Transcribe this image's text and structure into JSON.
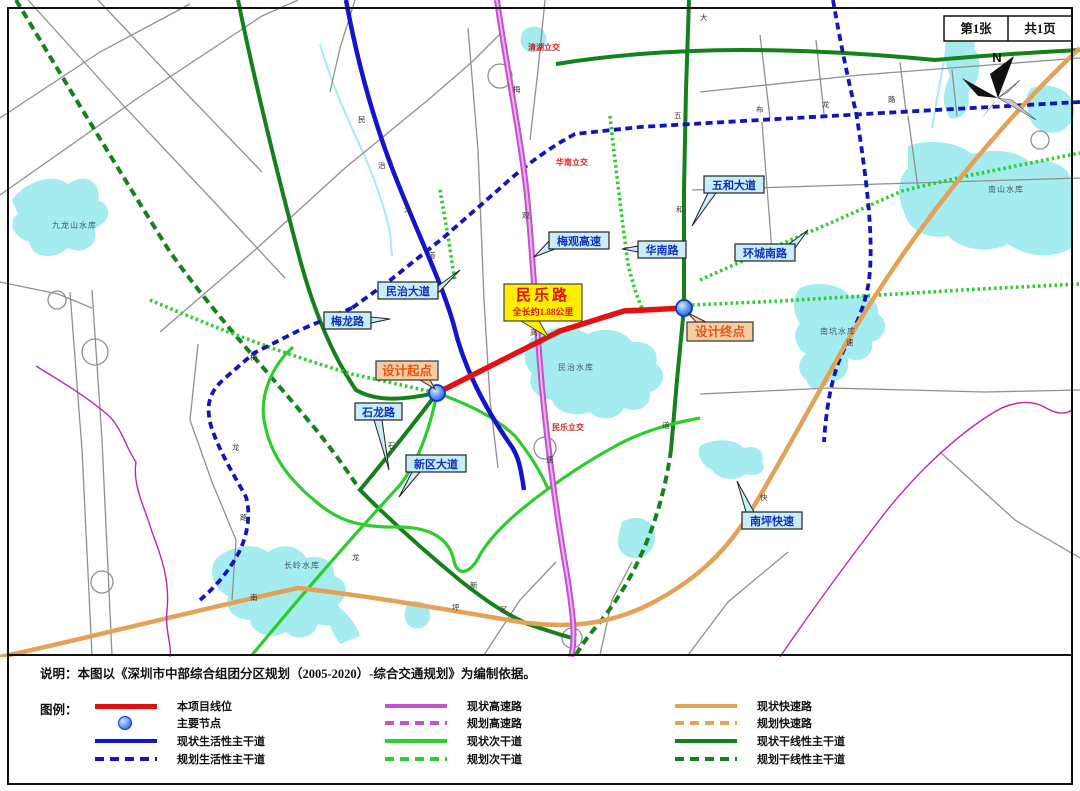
{
  "page": {
    "sheet_no": "第1张",
    "sheet_total": "共1页",
    "north_label": "N"
  },
  "note": "说明：本图以《深圳市中部综合组团分区规划（2005-2020）-综合交通规划》为编制依据。",
  "legend": {
    "title": "图例：",
    "items": [
      {
        "label": "本项目线位",
        "swatch": "project"
      },
      {
        "label": "主要节点",
        "swatch": "node"
      },
      {
        "label": "现状生活性主干道",
        "swatch": "blue-solid"
      },
      {
        "label": "规划生活性主干道",
        "swatch": "blue-dashed"
      },
      {
        "label": "现状高速路",
        "swatch": "magenta-solid"
      },
      {
        "label": "规划高速路",
        "swatch": "magenta-dashed"
      },
      {
        "label": "现状次干道",
        "swatch": "green-solid"
      },
      {
        "label": "规划次干道",
        "swatch": "green-dashed"
      },
      {
        "label": "现状快速路",
        "swatch": "orange-solid"
      },
      {
        "label": "规划快速路",
        "swatch": "orange-dashed"
      },
      {
        "label": "现状干线性主干道",
        "swatch": "dgreen-solid"
      },
      {
        "label": "规划干线性主干道",
        "swatch": "dgreen-dashed"
      }
    ]
  },
  "map": {
    "project_label": {
      "title": "民乐路",
      "subtitle": "全长约1.88公里"
    },
    "start_label": "设计起点",
    "end_label": "设计终点",
    "road_labels": [
      "民治大道",
      "梅龙路",
      "梅观高速",
      "华南路",
      "五和大道",
      "环城南路",
      "南坪快速",
      "石龙路",
      "新区大道"
    ],
    "interchange_labels": [
      {
        "t": "清湖立交",
        "x": 528,
        "y": 50
      },
      {
        "t": "华南立交",
        "x": 556,
        "y": 165
      },
      {
        "t": "民乐立交",
        "x": 552,
        "y": 430
      }
    ],
    "water_labels": [
      {
        "t": "九龙山水库",
        "x": 52,
        "y": 228
      },
      {
        "t": "南山水库",
        "x": 988,
        "y": 192
      },
      {
        "t": "南坑水库",
        "x": 820,
        "y": 334
      },
      {
        "t": "民治水库",
        "x": 558,
        "y": 370
      },
      {
        "t": "长岭水库",
        "x": 284,
        "y": 568
      }
    ],
    "road_chars": [
      {
        "t": "民",
        "x": 358,
        "y": 122
      },
      {
        "t": "治",
        "x": 378,
        "y": 168
      },
      {
        "t": "大",
        "x": 404,
        "y": 212
      },
      {
        "t": "道",
        "x": 428,
        "y": 258
      },
      {
        "t": "梅",
        "x": 513,
        "y": 92
      },
      {
        "t": "观",
        "x": 522,
        "y": 218
      },
      {
        "t": "高",
        "x": 530,
        "y": 335
      },
      {
        "t": "速",
        "x": 546,
        "y": 462
      },
      {
        "t": "五",
        "x": 674,
        "y": 118
      },
      {
        "t": "和",
        "x": 676,
        "y": 212
      },
      {
        "t": "大",
        "x": 700,
        "y": 20
      },
      {
        "t": "道",
        "x": 662,
        "y": 428
      },
      {
        "t": "布",
        "x": 756,
        "y": 112
      },
      {
        "t": "龙",
        "x": 822,
        "y": 107
      },
      {
        "t": "路",
        "x": 888,
        "y": 102
      },
      {
        "t": "梅",
        "x": 250,
        "y": 360
      },
      {
        "t": "龙",
        "x": 232,
        "y": 450
      },
      {
        "t": "路",
        "x": 240,
        "y": 520
      },
      {
        "t": "新",
        "x": 470,
        "y": 588
      },
      {
        "t": "区",
        "x": 500,
        "y": 612
      },
      {
        "t": "南",
        "x": 250,
        "y": 600
      },
      {
        "t": "坪",
        "x": 452,
        "y": 610
      },
      {
        "t": "快",
        "x": 760,
        "y": 500
      },
      {
        "t": "速",
        "x": 846,
        "y": 345
      },
      {
        "t": "石",
        "x": 388,
        "y": 448
      },
      {
        "t": "龙",
        "x": 352,
        "y": 560
      }
    ]
  },
  "colors": {
    "project_red": "#e01212",
    "node_blue": "#3377ee",
    "living_artery_blue": "#1414cc",
    "expressway_magenta": "#c253cc",
    "secondary_green": "#2ecc2e",
    "fast_road_orange": "#e2a257",
    "trunk_dark_green": "#15801c",
    "water_cyan": "#a5ecf0",
    "boundary_purple": "#b52ab5",
    "callout_blue_bg": "#c8ecf8",
    "callout_peach_bg": "#f6cda0",
    "project_label_yellow": "#ffee00"
  }
}
